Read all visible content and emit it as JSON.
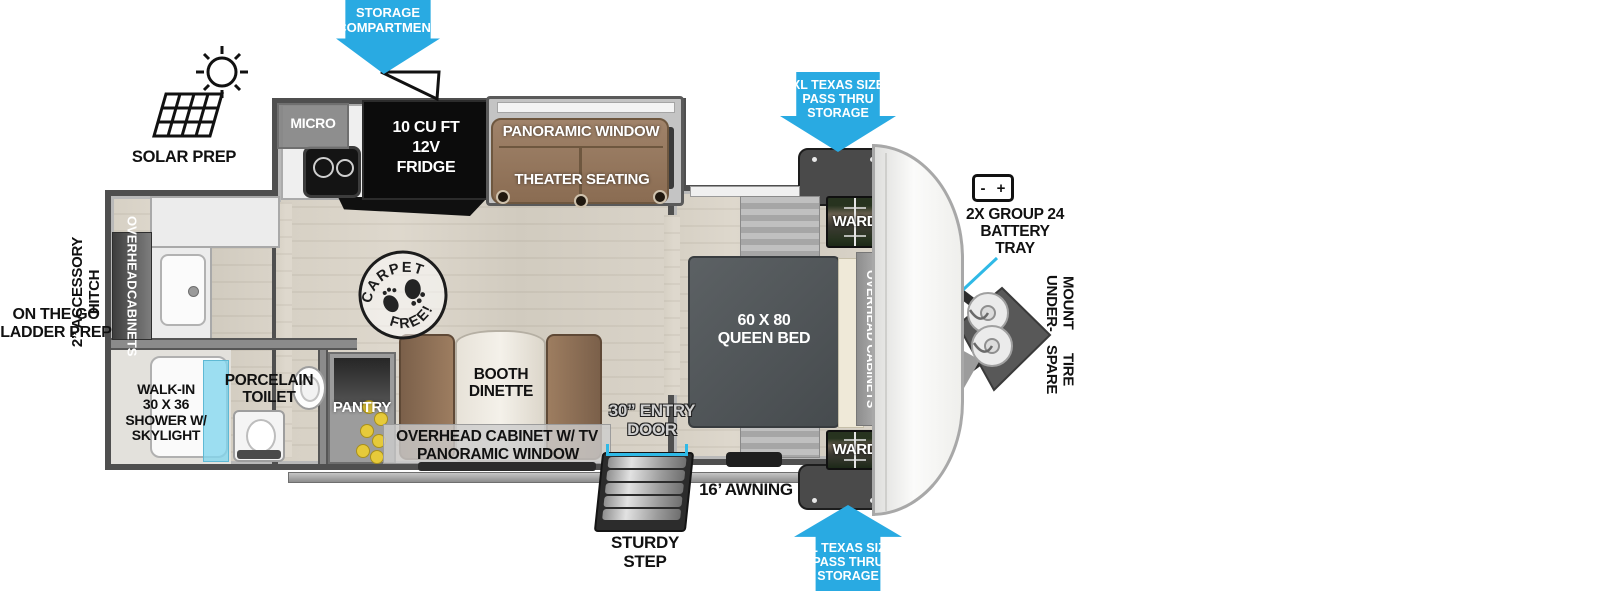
{
  "colors": {
    "callout_blue": "#29aae2",
    "dimension_cyan": "#2fb9e6",
    "shower_glass": "#8fd6ea",
    "seating_brown": "#91704f",
    "bed_gray": "#52575a"
  },
  "callouts": {
    "storage_compartment": {
      "l1": "STORAGE",
      "l2": "COMPARTMENT"
    },
    "pass_thru_top": {
      "l1": "XL TEXAS SIZE",
      "l2": "PASS THRU",
      "l3": "STORAGE"
    },
    "pass_thru_bottom": {
      "l1": "XL TEXAS SIZE",
      "l2": "PASS THRU",
      "l3": "STORAGE"
    },
    "solar_prep": "SOLAR PREP",
    "battery_tray": {
      "minus": "-",
      "plus": "+",
      "l1": "2X GROUP 24",
      "l2": "BATTERY",
      "l3": "TRAY"
    },
    "spare_tire": {
      "l1": "UNDER-MOUNT",
      "l2": "SPARE TIRE"
    },
    "accessory_hitch": {
      "l1": "2” ACCESSORY",
      "l2": "HITCH"
    },
    "ladder_prep": {
      "l1": "ON THE GO",
      "l2": "LADDER PREP"
    },
    "awning": "16’ AWNING",
    "entry_door": {
      "l1": "30” ENTRY",
      "l2": "DOOR"
    },
    "sturdy_step": {
      "l1": "STURDY",
      "l2": "STEP"
    }
  },
  "rooms": {
    "kitchen": {
      "micro": "MICRO",
      "fridge": {
        "l1": "10 CU FT",
        "l2": "12V",
        "l3": "FRIDGE"
      }
    },
    "living": {
      "window": "PANORAMIC WINDOW",
      "seating": "THEATER SEATING"
    },
    "dinette": {
      "l1": "BOOTH",
      "l2": "DINETTE",
      "cab1": "OVERHEAD CABINET W/ TV",
      "cab2": "PANORAMIC WINDOW"
    },
    "pantry": "PANTRY",
    "bath": {
      "shower": {
        "l1": "WALK-IN",
        "l2": "30 X 36",
        "l3": "SHOWER W/",
        "l4": "SKYLIGHT"
      },
      "toilet": {
        "l1": "PORCELAIN",
        "l2": "TOILET"
      }
    },
    "bedroom": {
      "bed": {
        "l1": "60 X  80",
        "l2": "QUEEN BED"
      },
      "ward_top": "WARD",
      "ward_bottom": "WARD",
      "overhead": "OVERHEAD CABINETS"
    },
    "rear": {
      "overhead": {
        "l1": "OVERHEAD",
        "l2": "CABINETS"
      }
    },
    "stamp": {
      "t1": "CARPET",
      "t2": "FREE!"
    }
  }
}
